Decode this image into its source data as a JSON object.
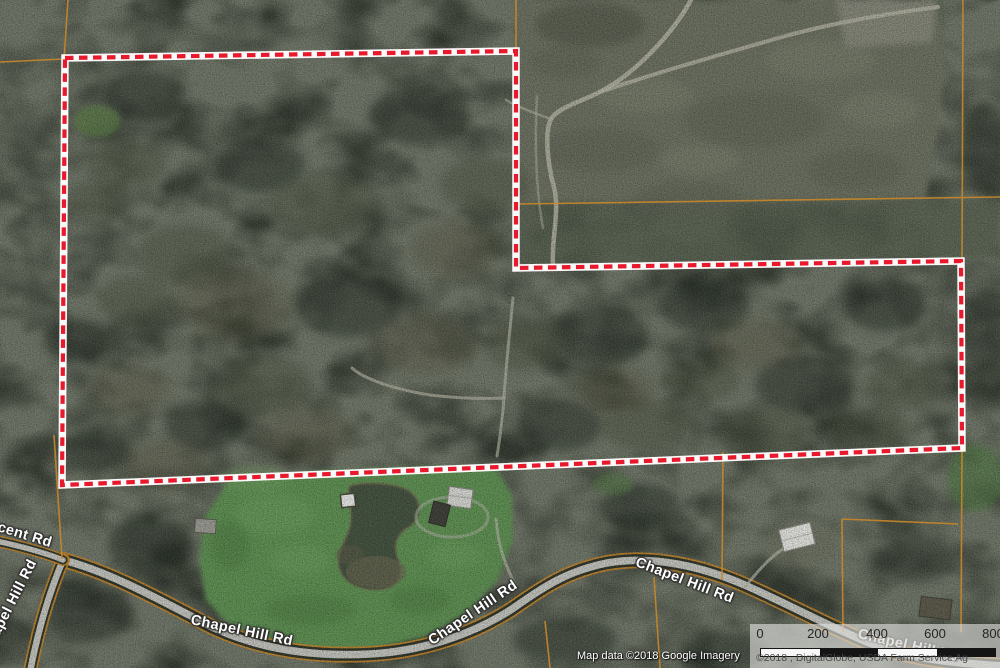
{
  "map": {
    "road_labels": {
      "chapel_hill": "Chapel Hill Rd",
      "crescent_partial": "cent Rd"
    },
    "scale_bar": {
      "ticks": [
        "0",
        "200",
        "400",
        "600",
        "800"
      ]
    },
    "attribution": {
      "white": "Map data ©2018 Google  Imagery",
      "panel": "©2018 , DigitalGlobe, USDA Farm Service Ag"
    },
    "colors": {
      "boundary_red": "#e8192c",
      "boundary_casing": "#ffffff",
      "parcel_line_orange": "#c8872a",
      "pasture_green": "#5e9253",
      "forest_dark": "#343b31",
      "clearcut_gray": "#6d7262",
      "road_gray": "#c6c7c1",
      "pond_dark": "#44523f",
      "scale_panel_gray": "#e2e2e0"
    }
  }
}
